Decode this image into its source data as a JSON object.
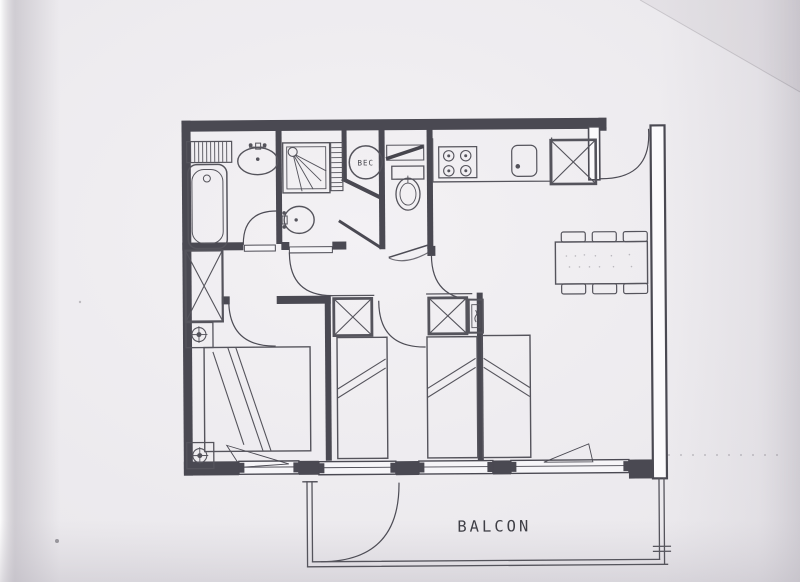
{
  "plan": {
    "labels": {
      "balcony": "BALCON",
      "water_heater": "BEC"
    },
    "colors": {
      "paper": "#edebee",
      "ink": "#45454c",
      "wall": "#4a4952"
    },
    "rooms": [
      "bathroom",
      "shower-room",
      "wc",
      "water-heater-closet",
      "hall",
      "kitchen",
      "living-room",
      "bedroom-1",
      "bedroom-2",
      "balcony"
    ],
    "fixtures": {
      "bathroom": [
        "towel-radiator",
        "bathtub",
        "washbasin"
      ],
      "shower_room": [
        "shower-cabin",
        "towel-radiator",
        "washbasin",
        "water-heater"
      ],
      "wc": [
        "toilet",
        "wall-shelf"
      ],
      "kitchen": [
        "cooktop-4-burners",
        "kitchen-sink",
        "closet"
      ],
      "living_room": [
        "dining-table",
        "chairs-x6",
        "single-bed"
      ],
      "bedroom_1": [
        "wardrobe",
        "double-bed",
        "nightstand-lamp",
        "nightstand-lamp"
      ],
      "bedroom_2": [
        "wardrobe",
        "single-bed",
        "single-bed",
        "wardrobe",
        "tall-cabinet"
      ]
    }
  }
}
